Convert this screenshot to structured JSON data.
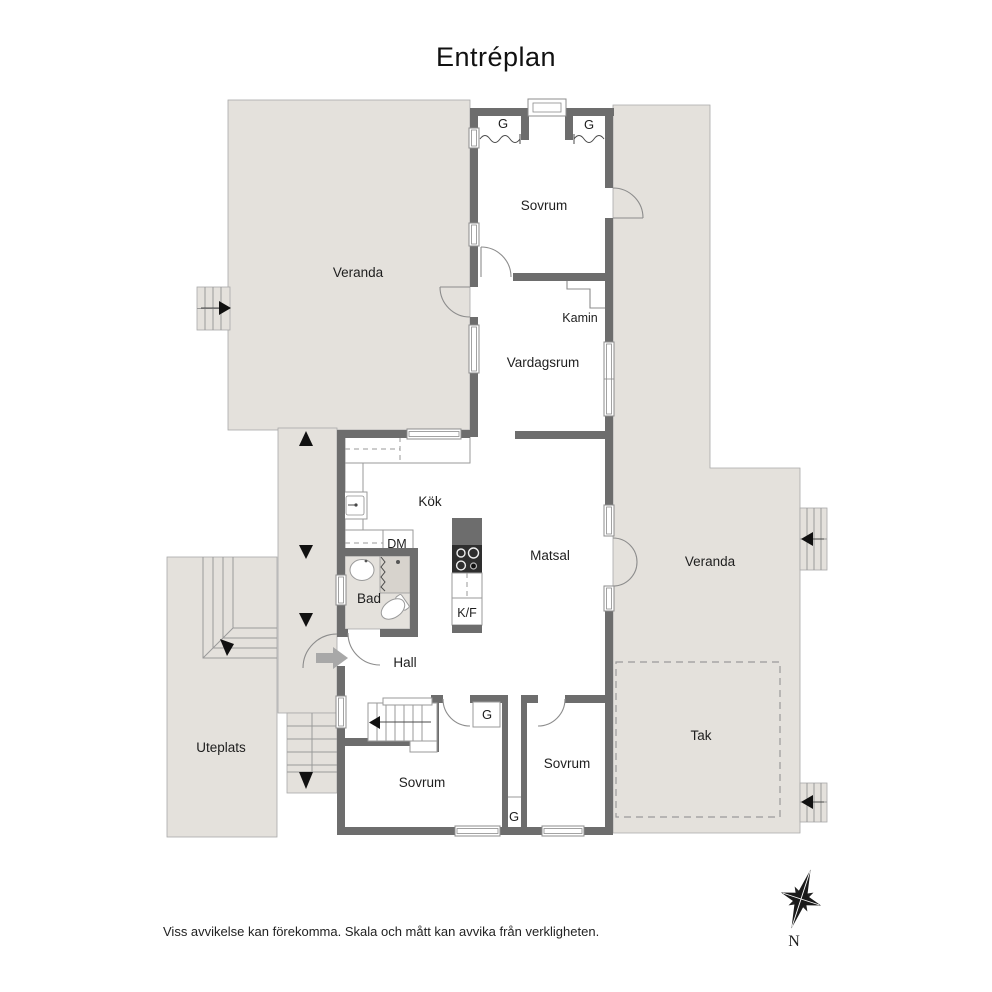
{
  "title": "Entréplan",
  "plan": {
    "rooms": {
      "veranda_left": "Veranda",
      "sovrum_top": "Sovrum",
      "vardagsrum": "Vardagsrum",
      "kok": "Kök",
      "bad": "Bad",
      "matsal": "Matsal",
      "veranda_right": "Veranda",
      "hall": "Hall",
      "uteplats": "Uteplats",
      "tak": "Tak",
      "sovrum_bottom_left": "Sovrum",
      "sovrum_bottom_right": "Sovrum"
    },
    "fixtures": {
      "fireplace": "Kamin",
      "dishwasher": "DM",
      "fridge_freezer": "K/F"
    },
    "closets": {
      "top_left": "G",
      "top_right": "G",
      "hall": "G",
      "shaft": "G"
    }
  },
  "compass": {
    "north": "N"
  },
  "footer": {
    "disclaimer": "Viss avvikelse kan förekomma. Skala och mått kan avvika från verkligheten."
  },
  "colors": {
    "outdoor": "#e4e1dc",
    "wall": "#6d6d6d",
    "floor": "#ffffff",
    "line": "#9a9a9a"
  }
}
